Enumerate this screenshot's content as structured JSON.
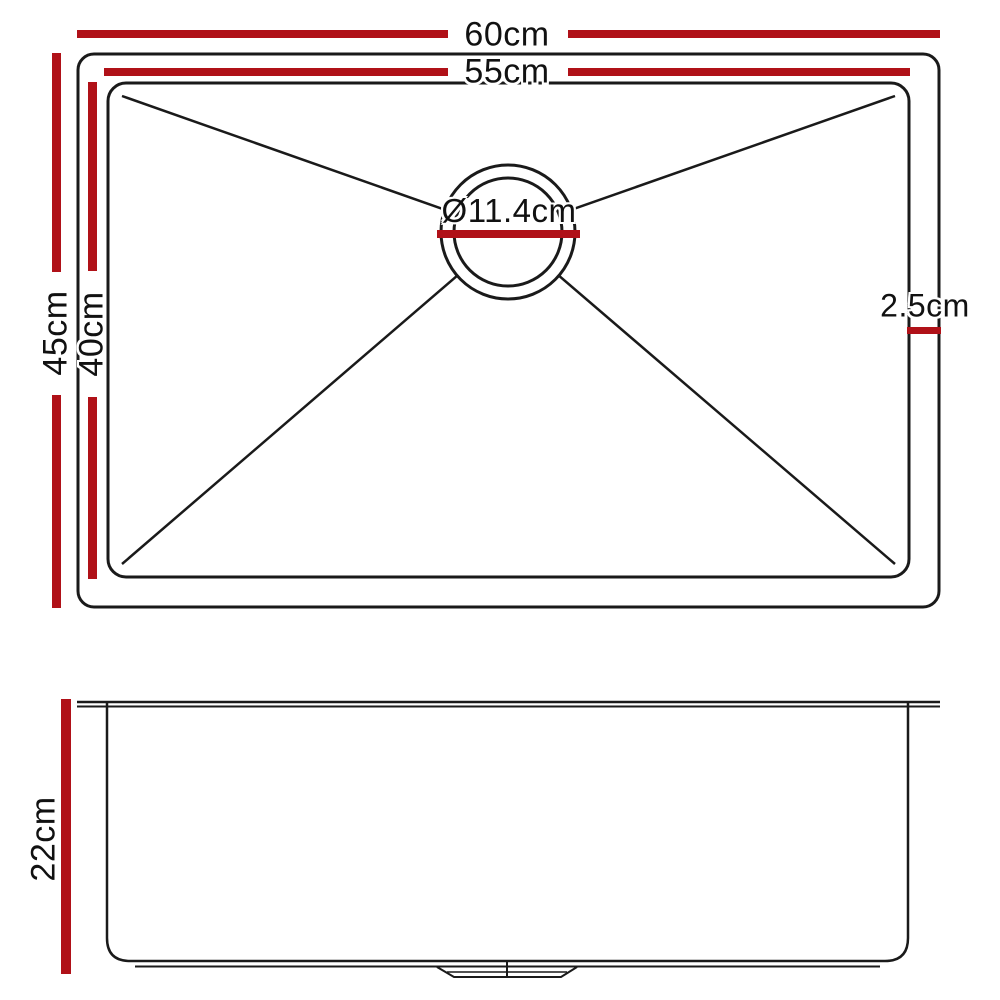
{
  "colors": {
    "dimension_red": "#B01118",
    "line_black": "#1A1A1A"
  },
  "top_view": {
    "description": "sink-top-view",
    "labels": {
      "outer_width": "60cm",
      "inner_width": "55cm",
      "outer_depth": "45cm",
      "inner_depth": "40cm",
      "drain_diameter": "Ø11.4cm",
      "rim_width": "2.5cm"
    }
  },
  "side_view": {
    "description": "sink-side-view",
    "labels": {
      "bowl_depth": "22cm"
    }
  }
}
